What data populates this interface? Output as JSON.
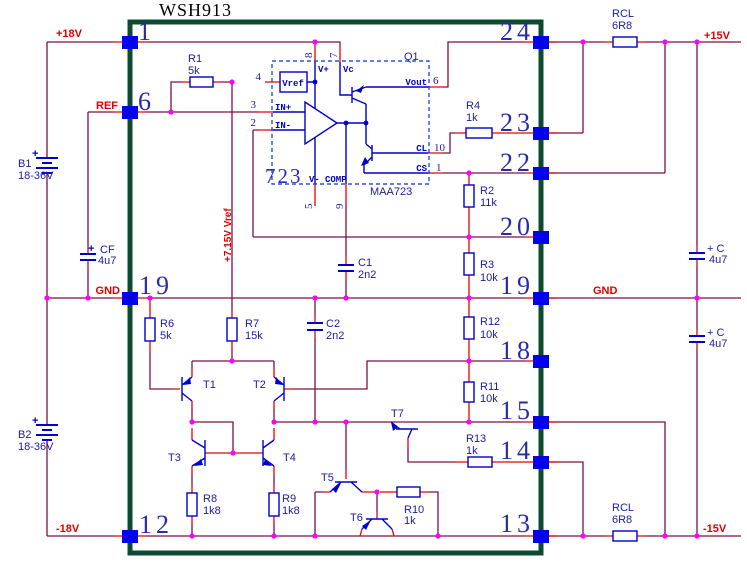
{
  "title": "WSH913",
  "nets": {
    "p18v": "+18V",
    "ref": "REF",
    "gnd_left": "GND",
    "n18v": "-18V",
    "p15v": "+15V",
    "gnd_right": "GND",
    "n15v": "-15V",
    "vref_rail": "+7.15V Vref"
  },
  "module_pins": {
    "p1": "1",
    "p6": "6",
    "p19l": "19",
    "p12": "12",
    "p24": "24",
    "p23": "23",
    "p22": "22",
    "p20": "20",
    "p19r": "19",
    "p18": "18",
    "p15": "15",
    "p14": "14",
    "p13": "13"
  },
  "ic": {
    "big": "723",
    "part": "MAA723",
    "desig": "Q1",
    "t": {
      "vref": "Vref",
      "vplus": "V+",
      "vc": "Vc",
      "vout": "Vout",
      "cl": "CL",
      "cs": "CS",
      "vminus": "V-",
      "comp": "COMP",
      "inp": "IN+",
      "inn": "IN-"
    },
    "p": {
      "vref": "4",
      "inp": "3",
      "inn": "2",
      "vplus": "8",
      "vc": "7",
      "vout": "6",
      "cl": "10",
      "cs": "1",
      "vminus": "5",
      "comp": "9"
    }
  },
  "components": {
    "r1": {
      "ref": "R1",
      "val": "5k"
    },
    "r2": {
      "ref": "R2",
      "val": "11k"
    },
    "r3": {
      "ref": "R3",
      "val": "10k"
    },
    "r4": {
      "ref": "R4",
      "val": "1k"
    },
    "r6": {
      "ref": "R6",
      "val": "5k"
    },
    "r7": {
      "ref": "R7",
      "val": "15k"
    },
    "r8": {
      "ref": "R8",
      "val": "1k8"
    },
    "r9": {
      "ref": "R9",
      "val": "1k8"
    },
    "r10": {
      "ref": "R10",
      "val": "1k"
    },
    "r11": {
      "ref": "R11",
      "val": "10k"
    },
    "r12": {
      "ref": "R12",
      "val": "10k"
    },
    "r13": {
      "ref": "R13",
      "val": "1k"
    },
    "rcl_top": {
      "ref": "RCL",
      "val": "6R8"
    },
    "rcl_bot": {
      "ref": "RCL",
      "val": "6R8"
    },
    "c1": {
      "ref": "C1",
      "val": "2n2"
    },
    "c2": {
      "ref": "C2",
      "val": "2n2"
    },
    "cf": {
      "ref": "CF",
      "val": "4u7",
      "plus": "+"
    },
    "c_top": {
      "ref": "+ C",
      "val": "4u7"
    },
    "c_bot": {
      "ref": "+ C",
      "val": "4u7"
    },
    "b1": {
      "ref": "B1",
      "val": "18-36V",
      "plus": "+"
    },
    "b2": {
      "ref": "B2",
      "val": "18-36V",
      "plus": "+"
    },
    "t1": {
      "ref": "T1"
    },
    "t2": {
      "ref": "T2"
    },
    "t3": {
      "ref": "T3"
    },
    "t4": {
      "ref": "T4"
    },
    "t5": {
      "ref": "T5"
    },
    "t6": {
      "ref": "T6"
    },
    "t7": {
      "ref": "T7"
    }
  }
}
